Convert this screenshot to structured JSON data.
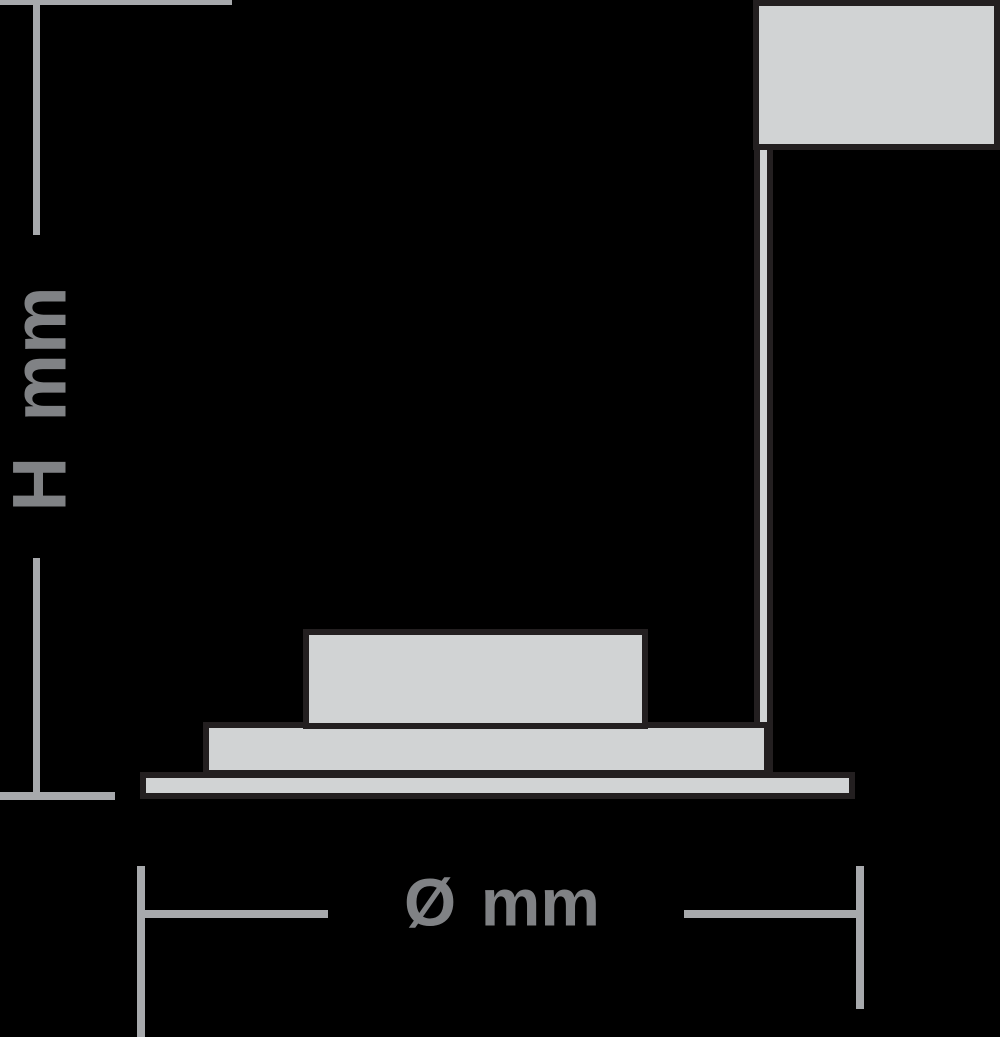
{
  "diagram": {
    "kind": "recessed-downlight-dimension-drawing",
    "labels": {
      "height": "H mm",
      "diameter": "Ø mm"
    }
  },
  "colors": {
    "background": "#000000",
    "outline": "#231f20",
    "surface_fill": "#d1d3d4",
    "dimension_line": "#a7a9ac",
    "label_text": "#808285"
  }
}
